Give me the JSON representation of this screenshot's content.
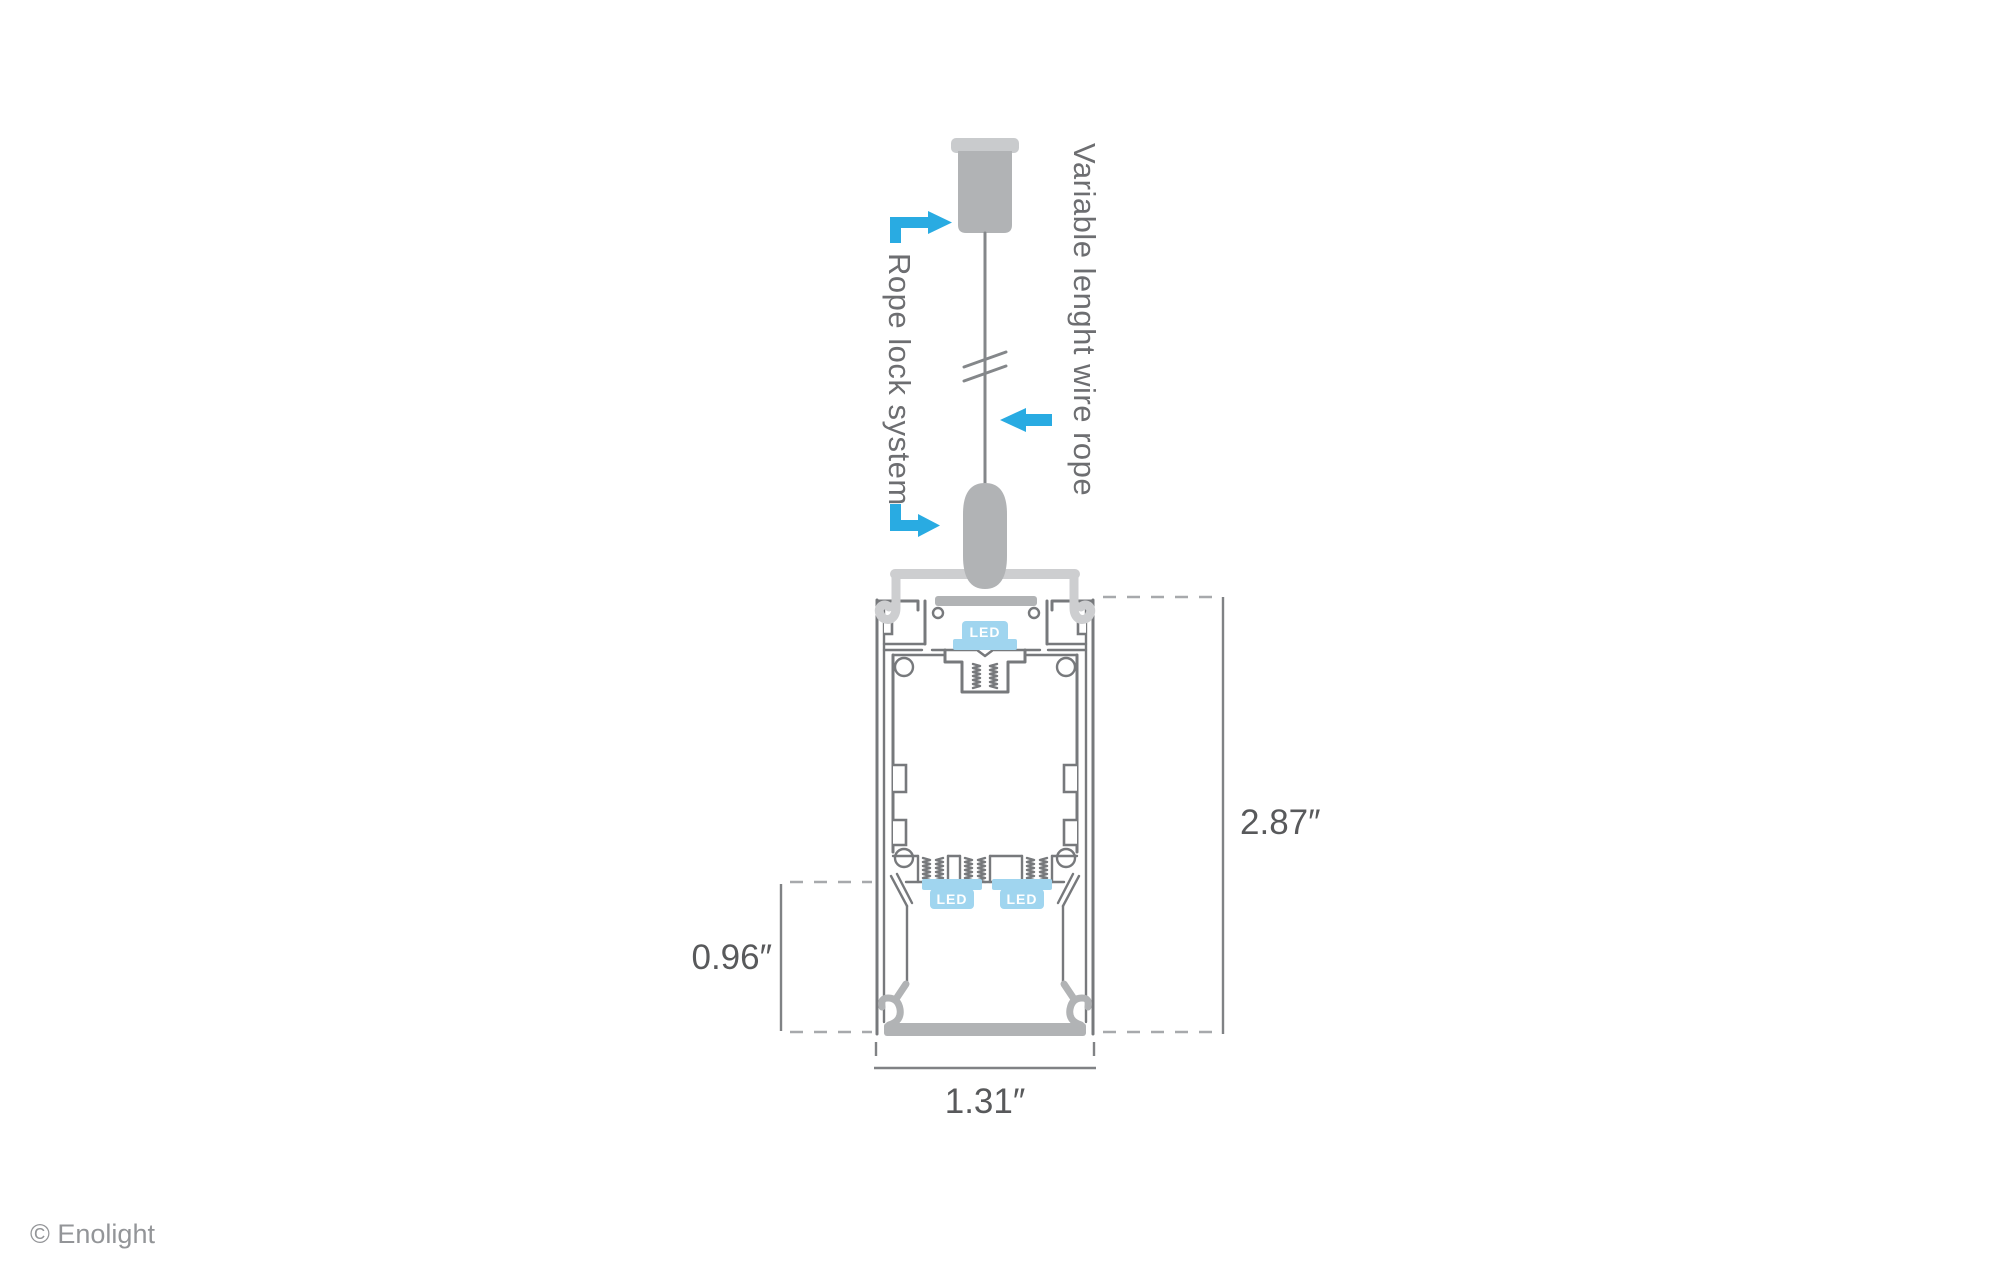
{
  "labels": {
    "rope_lock": "Rope lock system",
    "wire_rope": "Variable lenght wire rope"
  },
  "dimensions": {
    "overall_height": "2.87″",
    "lower_height": "0.96″",
    "width": "1.31″"
  },
  "led_labels": {
    "top": "LED",
    "bottom_left": "LED",
    "bottom_right": "LED"
  },
  "footer": {
    "copyright": "© Enolight"
  },
  "colors": {
    "accent": "#29abe2",
    "led_fill": "#a0d5ef",
    "profile_stroke": "#77797c",
    "metal_gray": "#b1b3b5",
    "bracket_gray": "#cdced0",
    "dim_text": "#58595b"
  }
}
